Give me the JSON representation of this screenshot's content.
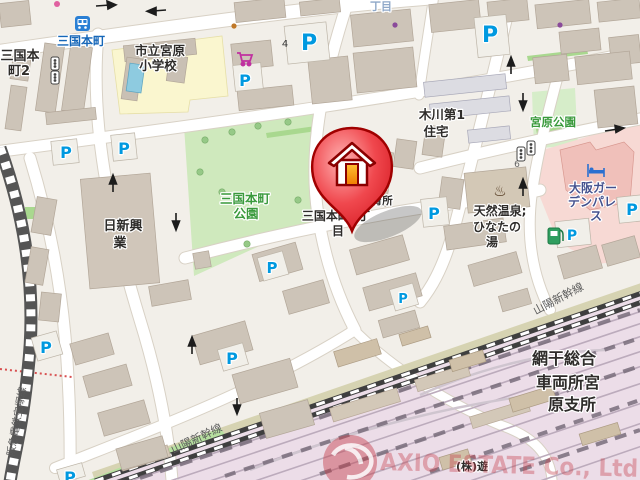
{
  "map": {
    "labels": {
      "bus_stop": "三国本町",
      "addr_mikunihoncho2_line1": "三国本",
      "addr_mikunihoncho2_line2": "町2",
      "school_line1": "市立宮原",
      "school_line2": "小学校",
      "choume_partial": "丁目",
      "house_number_4": "4",
      "house_number_6": "6",
      "kigawa_housing_line1": "木川第1",
      "kigawa_housing_line2": "住宅",
      "miyahara_park": "宮原公園",
      "mikuni_park_line1": "三国本町",
      "mikuni_park_line2": "公園",
      "nisshin_line1": "日新興",
      "nisshin_line2": "業",
      "marker_address_line1": "三国本町3丁",
      "marker_address_line2": "目",
      "nursery_line1": "立",
      "nursery_line2": "第2",
      "nursery_line3": "保育所",
      "onsen_line1": "天然温泉;",
      "onsen_line2": "ひなたの",
      "onsen_line3": "湯",
      "hotel_line1": "大阪ガー",
      "hotel_line2": "デンパレ",
      "hotel_line3": "ス",
      "shinkansen": "山陽新幹線",
      "hankyu_line": "阪急電鉄宝塚線",
      "depot_line1": "網干総合",
      "depot_line2": "車両所宮",
      "depot_line3": "原支所",
      "company": "(株)遊"
    },
    "symbols": {
      "parking": "P",
      "onsen": "♨"
    },
    "watermark": {
      "text": "AXIO ESTATE Co., Ltd"
    },
    "colors": {
      "road": "#ffffff",
      "block_background": "#f2efe9",
      "building": "#cdc4b8",
      "school_area": "#faf6cf",
      "park_green": "#cfe9bd",
      "rail_yard_pink": "#ecdde8",
      "hotel_pink": "#f7d9d4",
      "parking_blue": "#0099e0",
      "marker_red": "#e63333",
      "pool_blue": "#8ecbe0"
    }
  }
}
